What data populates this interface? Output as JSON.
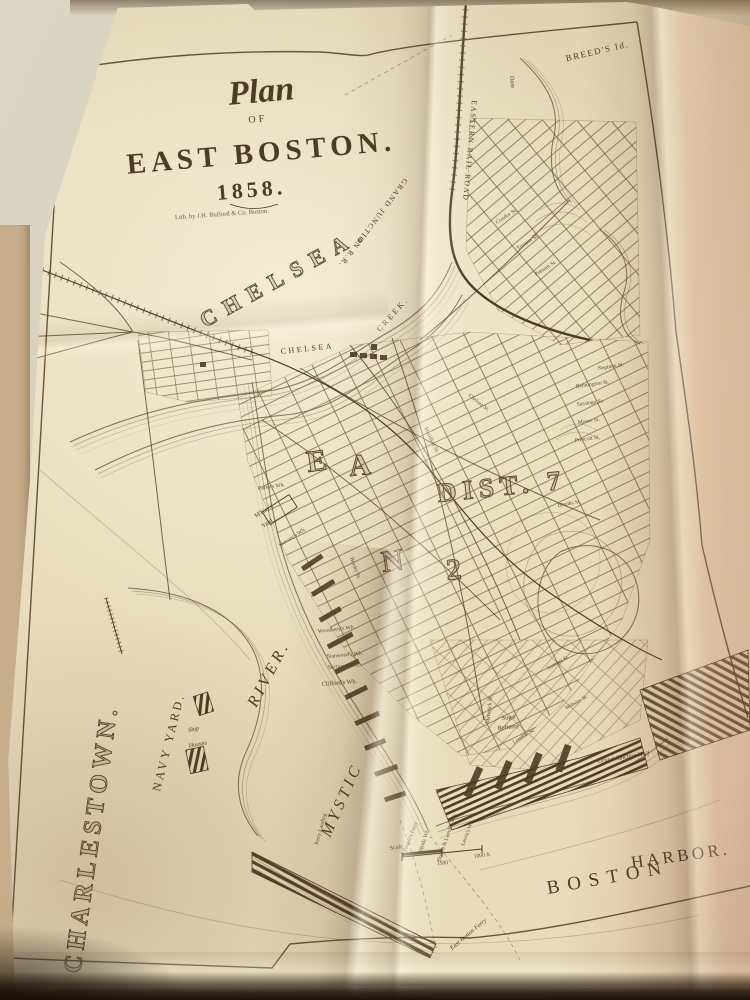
{
  "title": {
    "plan": "Plan",
    "of": "OF",
    "main": "EAST BOSTON.",
    "year": "1858.",
    "imprint": "Lith. by J.H. Bufford & Co. Boston."
  },
  "colors": {
    "paper": "#e9dcbd",
    "paper_light": "#efe4ca",
    "paper_pink": "#ddb896",
    "wall": "#d9d3c2",
    "under_page": "#c7ae8a",
    "ink": "#4f3b27",
    "ink_light": "#8a7050",
    "shadow_band": "#1d1007"
  },
  "map_labels": [
    {
      "id": "breeds-island",
      "text": "BREED'S Id.",
      "x": 598,
      "y": 54,
      "rot": -13,
      "cls": "t-med mid"
    },
    {
      "id": "eastern-rail-road",
      "text": "EASTERN RAIL ROAD",
      "x": 472,
      "y": 100,
      "rot": 95,
      "cls": "t-rr"
    },
    {
      "id": "dam",
      "text": "Dam",
      "x": 510,
      "y": 76,
      "rot": 85,
      "cls": "t-tiny-i"
    },
    {
      "id": "grand-junction-rr",
      "text": "GRAND JUNCTION R.R.",
      "x": 404,
      "y": 178,
      "rot": 127,
      "cls": "t-rr"
    },
    {
      "id": "chelsea",
      "text": "CHELSEA.",
      "x": 205,
      "y": 328,
      "rot": -29,
      "cls": "t-huge"
    },
    {
      "id": "chelsea-creek-1",
      "text": "CHELSEA",
      "x": 281,
      "y": 354,
      "rot": -6,
      "cls": "t-med8"
    },
    {
      "id": "chelsea-creek-2",
      "text": "CREEK.",
      "x": 380,
      "y": 332,
      "rot": -48,
      "cls": "t-med8"
    },
    {
      "id": "charlestown",
      "text": "CHARLESTOWN.",
      "x": 80,
      "y": 974,
      "rot": -82,
      "cls": "t-huge2"
    },
    {
      "id": "navy-yard",
      "text": "NAVY YARD.",
      "x": 160,
      "y": 792,
      "rot": -76,
      "cls": "t-navy"
    },
    {
      "id": "ship",
      "text": "Ship",
      "x": 194,
      "y": 731,
      "rot": -12,
      "cls": "t-tiny-i mid"
    },
    {
      "id": "houses",
      "text": "Houses",
      "x": 198,
      "y": 746,
      "rot": -10,
      "cls": "t-tiny-i mid"
    },
    {
      "id": "mystic",
      "text": "MYSTIC",
      "x": 330,
      "y": 838,
      "rot": -66,
      "cls": "t-river"
    },
    {
      "id": "river",
      "text": "RIVER.",
      "x": 256,
      "y": 708,
      "rot": -62,
      "cls": "t-river"
    },
    {
      "id": "boston",
      "text": "BOSTON",
      "x": 548,
      "y": 894,
      "rot": -10,
      "cls": "t-harbor"
    },
    {
      "id": "harbor",
      "text": "HARBOR.",
      "x": 632,
      "y": 868,
      "rot": -8,
      "cls": "t-harbor2"
    },
    {
      "id": "east-boston-ferry",
      "text": "East Boston Ferry",
      "x": 452,
      "y": 950,
      "rot": -40,
      "cls": "t-tiny-i"
    },
    {
      "id": "peoples-ferry",
      "text": "People's Ferry",
      "x": 406,
      "y": 852,
      "rot": -68,
      "cls": "t-micro"
    },
    {
      "id": "pagoda-wharf",
      "text": "Pagoda Wh.",
      "x": 420,
      "y": 855,
      "rot": -69,
      "cls": "t-micro"
    },
    {
      "id": "brown-lovells-wharf",
      "text": "Brown & Lovell's Wh.",
      "x": 440,
      "y": 862,
      "rot": -71,
      "cls": "t-micro"
    },
    {
      "id": "lewis-wharf",
      "text": "Lewis's Wh.",
      "x": 464,
      "y": 846,
      "rot": -69,
      "cls": "t-micro"
    },
    {
      "id": "ferry-landing",
      "text": "Ferry Landing",
      "x": 318,
      "y": 845,
      "rot": -75,
      "cls": "t-micro"
    },
    {
      "id": "scale",
      "text": "Scale",
      "x": 390,
      "y": 850,
      "rot": -8,
      "cls": "t-tiny"
    },
    {
      "id": "scale-1500",
      "text": "1500",
      "x": 437,
      "y": 865,
      "rot": -5,
      "cls": "t-micro"
    },
    {
      "id": "scale-1000ft",
      "text": "1000 ft.",
      "x": 474,
      "y": 858,
      "rot": -7,
      "cls": "t-micro"
    },
    {
      "id": "mckays-yard-1",
      "text": "M'Kay's",
      "x": 256,
      "y": 518,
      "rot": -33,
      "cls": "t-tiny"
    },
    {
      "id": "mckays-yard-2",
      "text": "Yard",
      "x": 263,
      "y": 528,
      "rot": -33,
      "cls": "t-tiny"
    },
    {
      "id": "stevens-wharf",
      "text": "Stevens's Wh.",
      "x": 280,
      "y": 547,
      "rot": -33,
      "cls": "t-micro"
    },
    {
      "id": "careys-wharf",
      "text": "Carey's Wh.",
      "x": 258,
      "y": 490,
      "rot": -8,
      "cls": "t-micro"
    },
    {
      "id": "woodburys-wharf",
      "text": "Woodbury's Wh.",
      "x": 318,
      "y": 633,
      "rot": -7,
      "cls": "t-micro"
    },
    {
      "id": "stanwoods-wharf",
      "text": "Stanwood's Wh.",
      "x": 327,
      "y": 658,
      "rot": -5,
      "cls": "t-micro"
    },
    {
      "id": "sectional-dock",
      "text": "Sectional Dock",
      "x": 328,
      "y": 669,
      "rot": -5,
      "cls": "t-micro"
    },
    {
      "id": "cliffords-wharf",
      "text": "Clifford's Wh.",
      "x": 322,
      "y": 686,
      "rot": -5,
      "cls": "t-tiny"
    },
    {
      "id": "sugar-refinery-1",
      "text": "Sugar",
      "x": 502,
      "y": 720,
      "rot": -7,
      "cls": "t-tiny"
    },
    {
      "id": "sugar-refinery-2",
      "text": "Refinery",
      "x": 498,
      "y": 730,
      "rot": -7,
      "cls": "t-tiny"
    },
    {
      "id": "grand-junction-wharf",
      "text": "Grand Junction Wh'f",
      "x": 598,
      "y": 763,
      "rot": -9,
      "cls": "t-tiny-i"
    },
    {
      "id": "maverick-st",
      "text": "Maverick St.",
      "x": 489,
      "y": 724,
      "rot": -83,
      "cls": "t-micro"
    },
    {
      "id": "sumner-st",
      "text": "Sumner St.",
      "x": 548,
      "y": 670,
      "rot": -30,
      "cls": "t-micro"
    },
    {
      "id": "webster-st",
      "text": "Webster St.",
      "x": 566,
      "y": 710,
      "rot": -30,
      "cls": "t-micro"
    },
    {
      "id": "london-st",
      "text": "London St.",
      "x": 514,
      "y": 744,
      "rot": -32,
      "cls": "t-micro"
    },
    {
      "id": "meridian-st",
      "text": "Meridian St.",
      "x": 424,
      "y": 428,
      "rot": 64,
      "cls": "t-micro"
    },
    {
      "id": "border-st",
      "text": "Border St.",
      "x": 350,
      "y": 558,
      "rot": 70,
      "cls": "t-micro"
    },
    {
      "id": "chelsea-st",
      "text": "Chelsea St.",
      "x": 468,
      "y": 396,
      "rot": 38,
      "cls": "t-micro"
    },
    {
      "id": "condor-st",
      "text": "Condor St.",
      "x": 497,
      "y": 224,
      "rot": -33,
      "cls": "t-micro"
    },
    {
      "id": "trenton-st",
      "text": "Trenton St.",
      "x": 518,
      "y": 250,
      "rot": -33,
      "cls": "t-micro"
    },
    {
      "id": "putnam-st",
      "text": "Putnam St.",
      "x": 536,
      "y": 276,
      "rot": -33,
      "cls": "t-micro"
    },
    {
      "id": "neptune-st",
      "text": "Neptune St.",
      "x": 598,
      "y": 370,
      "rot": -9,
      "cls": "t-micro"
    },
    {
      "id": "bennington-st",
      "text": "Bennington St.",
      "x": 576,
      "y": 388,
      "rot": -8,
      "cls": "t-micro"
    },
    {
      "id": "saratoga-st",
      "text": "Saratoga St.",
      "x": 577,
      "y": 406,
      "rot": -8,
      "cls": "t-micro"
    },
    {
      "id": "moore-st",
      "text": "Moore St.",
      "x": 578,
      "y": 424,
      "rot": -8,
      "cls": "t-micro"
    },
    {
      "id": "prescott-st",
      "text": "Prescott St.",
      "x": 575,
      "y": 442,
      "rot": -8,
      "cls": "t-micro"
    },
    {
      "id": "brooks-st",
      "text": "Brooks St.",
      "x": 558,
      "y": 507,
      "rot": -10,
      "cls": "t-micro"
    },
    {
      "id": "district-e",
      "text": "E",
      "x": 308,
      "y": 472,
      "rot": -8,
      "cls": "t-huge3"
    },
    {
      "id": "district-a",
      "text": "A",
      "x": 350,
      "y": 476,
      "rot": -6,
      "cls": "t-huge3"
    },
    {
      "id": "district-7",
      "text": "DIST. 7",
      "x": 438,
      "y": 502,
      "rot": -6,
      "cls": "t-huge4"
    },
    {
      "id": "district-n",
      "text": "N",
      "x": 383,
      "y": 572,
      "rot": -8,
      "cls": "t-huge3"
    },
    {
      "id": "district-2",
      "text": "2",
      "x": 447,
      "y": 580,
      "rot": -5,
      "cls": "t-huge3"
    }
  ]
}
